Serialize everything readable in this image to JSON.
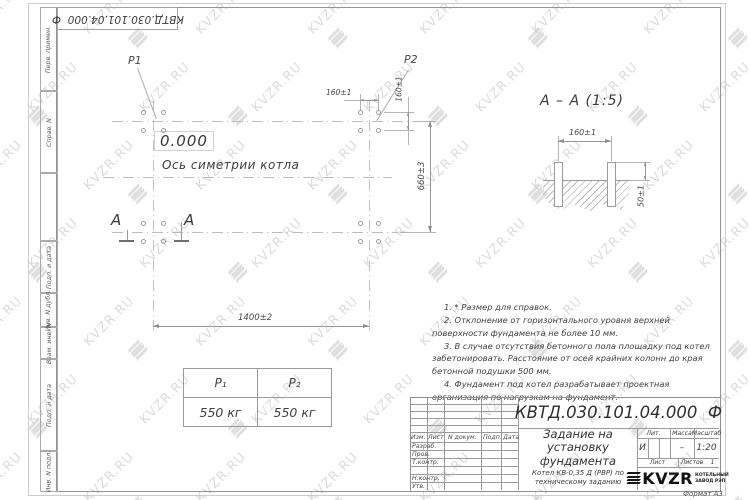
{
  "page": {
    "designation_top": "КВТД.030.101.04.000  Ф",
    "format_label": "Формат А3"
  },
  "colors": {
    "line": "#b4b4b4",
    "dark_line": "#9a9a9a",
    "text": "#474747",
    "watermark": "#bfbfbf",
    "logo": "#161616"
  },
  "side_strip": {
    "items": [
      "Перв. примен.",
      "Справ. N",
      "",
      "Подп. и дата",
      "Инв. N дубл.",
      "Взам. инв. N",
      "Подп. и дата",
      "Инв. N подл."
    ]
  },
  "plan": {
    "p1_label": "P1",
    "p2_label": "P2",
    "level_mark": "0.000",
    "axis_label": "Ось симетрии котла",
    "section_letter": "А",
    "dim_width": "1400±2",
    "dim_height": "660±3",
    "dim_bolt_x": "160±1",
    "dim_bolt_y": "160±1"
  },
  "section": {
    "title": "А – А (1:5)",
    "dim_spacing": "160±1",
    "dim_protrusion": "50±1"
  },
  "load_table": {
    "headers": [
      "Р₁",
      "Р₂"
    ],
    "values": [
      "550 кг",
      "550 кг"
    ]
  },
  "notes": [
    "1. * Размер для справок.",
    "2. Отклонение от горизонтального уровня верхней поверхности фундамента не более 10 мм.",
    "3. В случае отсутствия бетонного пола площадку под котел забетонировать. Расстояние от осей крайних колонн до края бетонной подушки 500 мм.",
    "4. Фундамент под котел разрабатывает проектная организация по нагрузкам на фундамент."
  ],
  "title_block": {
    "designation": "КВТД.030.101.04.000  Ф",
    "doc_title": "Задание на установку фундамента",
    "product": "Котел КВ-0,35 Д (РВР) по техническому заданию",
    "header_cols": [
      "Изм.",
      "Лист",
      "N докум.",
      "Подп.",
      "Дата"
    ],
    "rows": [
      "Разраб.",
      "Пров.",
      "Т.контр.",
      "Н.контр.",
      "Утв."
    ],
    "lit_label": "Лит.",
    "lit_value": "И",
    "mass_label": "Масса",
    "mass_value": "–",
    "scale_label": "Масштаб",
    "scale_value": "1:20",
    "sheet_label": "Лист",
    "sheets_label": "Листов",
    "sheets_value": "1",
    "logo_text": "KVZR",
    "logo_sub1": "КОТЕЛЬНЫЙ",
    "logo_sub2": "ЗАВОД РЭП"
  },
  "watermark": {
    "text": "KVZR.RU"
  }
}
